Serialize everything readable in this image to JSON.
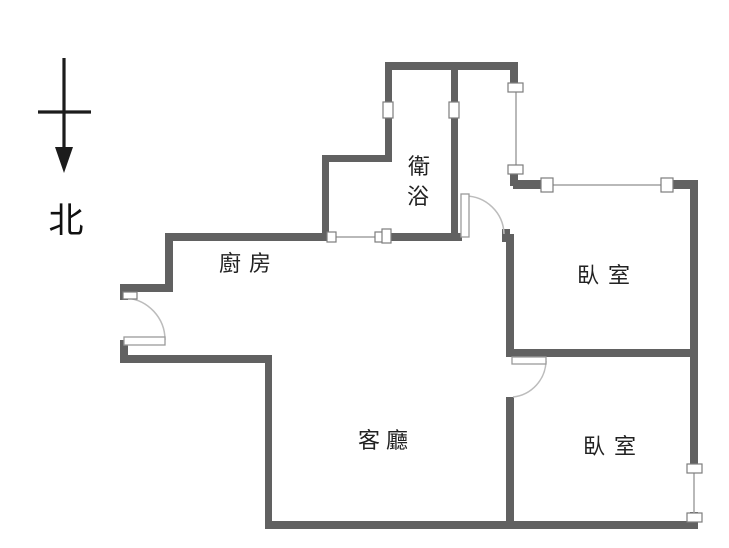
{
  "compass": {
    "label": "北"
  },
  "rooms": {
    "kitchen": "廚房",
    "bathroom_line1": "衛",
    "bathroom_line2": "浴",
    "bedroom_top": "臥室",
    "bedroom_bottom": "臥室",
    "living": "客廳"
  },
  "colors": {
    "wall": "#616161",
    "window_line": "#b9b9b9",
    "cap_border": "#7d7d7d",
    "leaf_border": "#9a9a9a",
    "arc": "#bcbcbc",
    "ink": "#1c1c1c"
  },
  "floorplan": {
    "walls": [
      [
        386,
        62,
        132,
        8
      ],
      [
        510,
        70,
        8,
        18
      ],
      [
        510,
        170,
        8,
        16
      ],
      [
        513,
        180,
        33,
        9
      ],
      [
        672,
        180,
        26,
        9
      ],
      [
        690,
        180,
        8,
        286
      ],
      [
        690,
        512,
        8,
        17
      ],
      [
        265,
        521,
        433,
        8
      ],
      [
        265,
        355,
        7,
        174
      ],
      [
        120,
        355,
        152,
        8
      ],
      [
        120,
        340,
        8,
        17
      ],
      [
        120,
        284,
        8,
        16
      ],
      [
        120,
        284,
        53,
        8
      ],
      [
        165,
        233,
        8,
        59
      ],
      [
        165,
        233,
        161,
        8
      ],
      [
        388,
        233,
        74,
        8
      ],
      [
        322,
        155,
        7,
        86
      ],
      [
        322,
        155,
        68,
        7
      ],
      [
        385,
        62,
        7,
        100
      ],
      [
        451,
        62,
        7,
        179
      ],
      [
        502,
        229,
        8,
        13
      ],
      [
        506,
        234,
        8,
        123
      ],
      [
        506,
        349,
        192,
        8
      ],
      [
        506,
        397,
        8,
        132
      ]
    ],
    "windows": [
      {
        "line": [
          516,
          88,
          516,
          168
        ],
        "caps": [
          [
            508,
            83,
            15,
            9
          ],
          [
            508,
            165,
            15,
            9
          ]
        ]
      },
      {
        "line": [
          553,
          185,
          663,
          185
        ],
        "caps": [
          [
            541,
            178,
            12,
            14
          ],
          [
            661,
            178,
            12,
            14
          ]
        ]
      },
      {
        "line": [
          694,
          472,
          694,
          515
        ],
        "caps": [
          [
            687,
            464,
            15,
            9
          ],
          [
            687,
            513,
            15,
            9
          ]
        ]
      },
      {
        "line": [
          336,
          237,
          378,
          237
        ],
        "caps": [
          [
            327,
            232,
            9,
            10
          ],
          [
            375,
            232,
            8,
            10
          ],
          [
            382,
            229,
            9,
            14
          ]
        ]
      }
    ],
    "vents": [
      [
        383,
        102,
        10,
        16
      ],
      [
        449,
        102,
        10,
        16
      ],
      [
        123,
        292,
        14,
        7
      ]
    ],
    "doors": [
      {
        "leaf": [
          124,
          337,
          41,
          8
        ],
        "arc": "M 165 340 A 42 42 0 0 0 126 298"
      },
      {
        "leaf": [
          461,
          194,
          8,
          43
        ],
        "arc": "M 465 196 A 39 39 0 0 1 504 234"
      },
      {
        "leaf": [
          512,
          357,
          34,
          7
        ],
        "arc": "M 546 361 A 37 37 0 0 1 513 397"
      }
    ],
    "compass": {
      "shaft": [
        64,
        58,
        64,
        152
      ],
      "crossbar": [
        38,
        112,
        91,
        112
      ],
      "head": "64,173 55,147 73,147"
    }
  }
}
